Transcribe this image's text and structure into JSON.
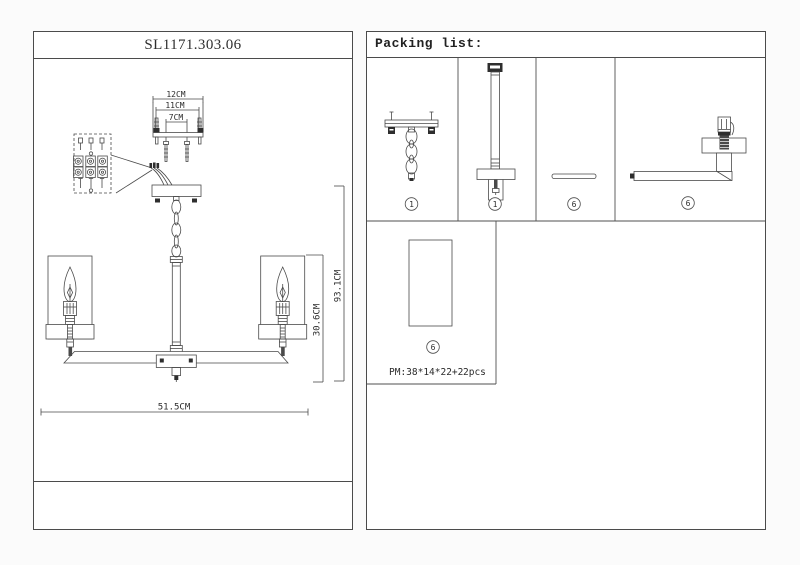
{
  "drawing": {
    "title": "SL1171.303.06",
    "dims": {
      "mount_outer": "12CM",
      "mount_mid": "11CM",
      "mount_inner": "7CM",
      "overall_height": "93.1CM",
      "body_height": "30.6CM",
      "overall_width": "51.5CM"
    }
  },
  "packing_list": {
    "title": "Packing list:",
    "items": [
      {
        "part": "hanger-bracket-with-chain",
        "badge": "1"
      },
      {
        "part": "down-rod-with-canopy",
        "badge": "1"
      },
      {
        "part": "flat-strip",
        "badge": "6"
      },
      {
        "part": "arm-with-socket",
        "badge": "6"
      },
      {
        "part": "glass-shade",
        "badge": "6"
      }
    ],
    "box_spec": "PM:38*14*22+2",
    "box_qty": "2pcs"
  }
}
